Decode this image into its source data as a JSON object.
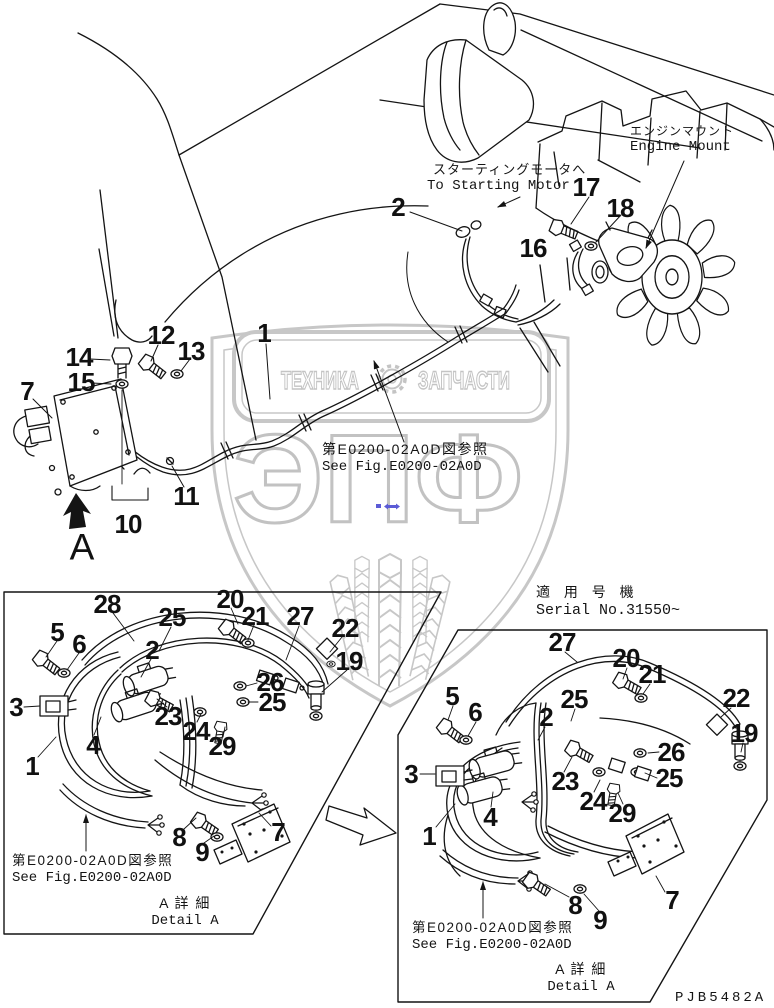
{
  "page": {
    "width": 774,
    "height": 1008,
    "background": "#ffffff",
    "drawing_code": "PJB5482A"
  },
  "colors": {
    "line": "#141414",
    "watermark_gray": "#c7c7c7",
    "accent_blue": "#5b5bd6"
  },
  "watermark": {
    "brand": "ЭПФ",
    "banner_left": "ТЕХНИКА",
    "banner_right": "ЗАПЧАСТИ",
    "gear_icon": "gear"
  },
  "annotations": {
    "starting_motor_jp": "スターティングモータへ",
    "starting_motor_en": "To Starting Motor",
    "engine_mount_jp": "エンジンマウント",
    "engine_mount_en": "Engine Mount",
    "see_fig_jp": "第E0200-02A0D図参照",
    "see_fig_en": "See Fig.E0200-02A0D"
  },
  "main_callouts": [
    {
      "label": "2",
      "x": 398,
      "y": 207
    },
    {
      "label": "17",
      "x": 586,
      "y": 187
    },
    {
      "label": "18",
      "x": 620,
      "y": 208
    },
    {
      "label": "16",
      "x": 533,
      "y": 248
    },
    {
      "label": "1",
      "x": 264,
      "y": 333
    },
    {
      "label": "12",
      "x": 161,
      "y": 335
    },
    {
      "label": "13",
      "x": 191,
      "y": 351
    },
    {
      "label": "14",
      "x": 79,
      "y": 357
    },
    {
      "label": "15",
      "x": 81,
      "y": 382
    },
    {
      "label": "7",
      "x": 27,
      "y": 391
    },
    {
      "label": "11",
      "x": 186,
      "y": 496
    },
    {
      "label": "10",
      "x": 128,
      "y": 524
    },
    {
      "label": "A",
      "x": 82,
      "y": 547,
      "kind": "letter"
    }
  ],
  "detail_left": {
    "see_fig_jp": "第E0200-02A0D図参照",
    "see_fig_en": "See Fig.E0200-02A0D",
    "title_jp": "A 詳 細",
    "title_en": "Detail A",
    "callouts": [
      {
        "label": "28",
        "x": 107,
        "y": 604
      },
      {
        "label": "20",
        "x": 230,
        "y": 599
      },
      {
        "label": "21",
        "x": 255,
        "y": 616
      },
      {
        "label": "27",
        "x": 300,
        "y": 616
      },
      {
        "label": "25",
        "x": 172,
        "y": 617
      },
      {
        "label": "5",
        "x": 57,
        "y": 632
      },
      {
        "label": "6",
        "x": 79,
        "y": 644
      },
      {
        "label": "2",
        "x": 152,
        "y": 650
      },
      {
        "label": "22",
        "x": 345,
        "y": 628
      },
      {
        "label": "19",
        "x": 349,
        "y": 661
      },
      {
        "label": "3",
        "x": 16,
        "y": 707
      },
      {
        "label": "26",
        "x": 270,
        "y": 682
      },
      {
        "label": "25",
        "x": 272,
        "y": 702
      },
      {
        "label": "23",
        "x": 168,
        "y": 716
      },
      {
        "label": "24",
        "x": 196,
        "y": 731
      },
      {
        "label": "29",
        "x": 222,
        "y": 746
      },
      {
        "label": "4",
        "x": 93,
        "y": 745
      },
      {
        "label": "1",
        "x": 32,
        "y": 766
      },
      {
        "label": "8",
        "x": 179,
        "y": 837
      },
      {
        "label": "9",
        "x": 202,
        "y": 852
      },
      {
        "label": "7",
        "x": 278,
        "y": 832
      }
    ]
  },
  "detail_right": {
    "serial_jp": "適 用 号 機",
    "serial_en": "Serial No.31550~",
    "see_fig_jp": "第E0200-02A0D図参照",
    "see_fig_en": "See Fig.E0200-02A0D",
    "title_jp": "A 詳 細",
    "title_en": "Detail A",
    "callouts": [
      {
        "label": "27",
        "x": 562,
        "y": 642
      },
      {
        "label": "20",
        "x": 626,
        "y": 658
      },
      {
        "label": "21",
        "x": 652,
        "y": 674
      },
      {
        "label": "25",
        "x": 574,
        "y": 699
      },
      {
        "label": "2",
        "x": 546,
        "y": 717
      },
      {
        "label": "22",
        "x": 736,
        "y": 698
      },
      {
        "label": "19",
        "x": 744,
        "y": 733
      },
      {
        "label": "5",
        "x": 452,
        "y": 696
      },
      {
        "label": "6",
        "x": 475,
        "y": 712
      },
      {
        "label": "3",
        "x": 411,
        "y": 774
      },
      {
        "label": "26",
        "x": 671,
        "y": 752
      },
      {
        "label": "25",
        "x": 669,
        "y": 778
      },
      {
        "label": "23",
        "x": 565,
        "y": 781
      },
      {
        "label": "24",
        "x": 593,
        "y": 801
      },
      {
        "label": "29",
        "x": 622,
        "y": 813
      },
      {
        "label": "4",
        "x": 490,
        "y": 817
      },
      {
        "label": "1",
        "x": 429,
        "y": 836
      },
      {
        "label": "8",
        "x": 575,
        "y": 905
      },
      {
        "label": "9",
        "x": 600,
        "y": 920
      },
      {
        "label": "7",
        "x": 672,
        "y": 900
      }
    ]
  }
}
